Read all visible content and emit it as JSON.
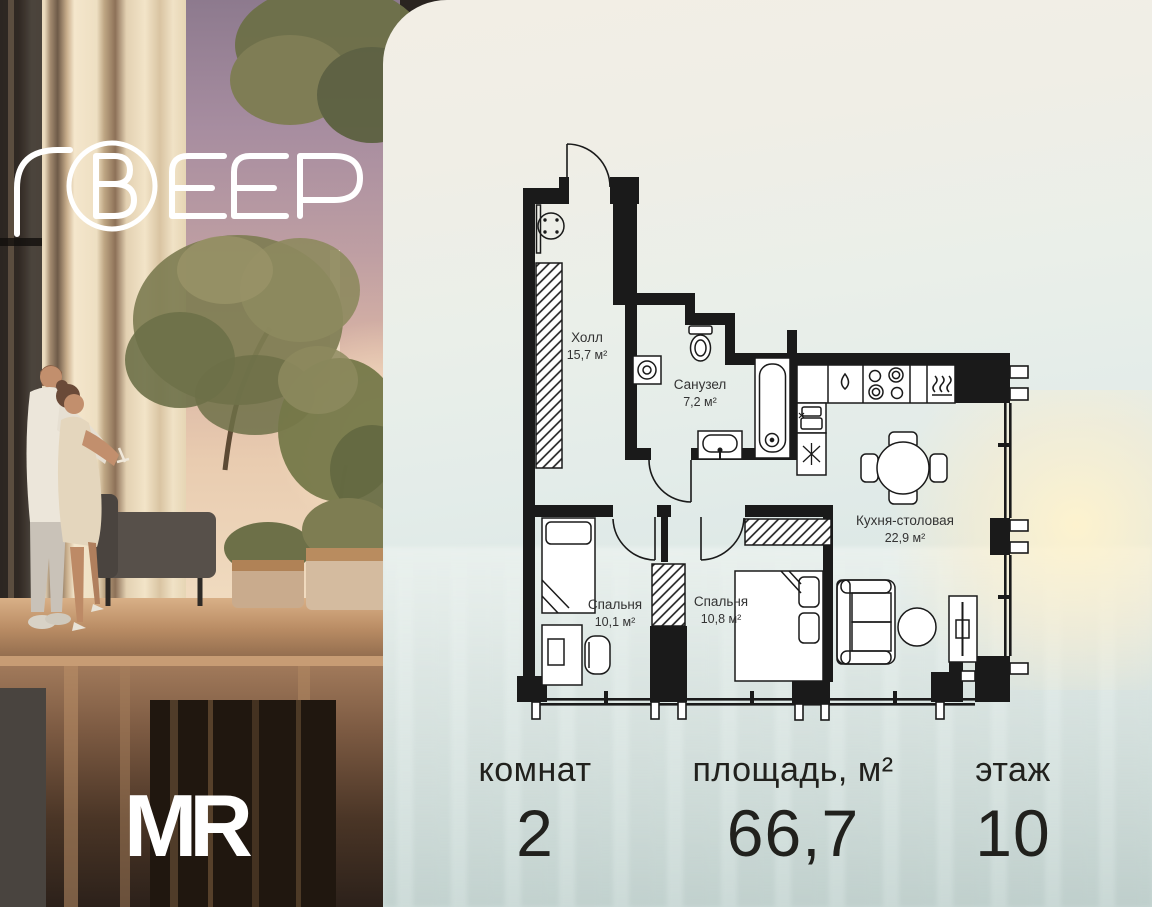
{
  "brand": {
    "project_logo": "ВЕЕР",
    "developer_logo": "MR"
  },
  "floor_plan": {
    "rooms": [
      {
        "name": "Холл",
        "area": "15,7 м²"
      },
      {
        "name": "Санузел",
        "area": "7,2 м²"
      },
      {
        "name": "Кухня-столовая",
        "area": "22,9 м²"
      },
      {
        "name": "Спальня",
        "area": "10,1 м²"
      },
      {
        "name": "Спальня",
        "area": "10,8 м²"
      }
    ]
  },
  "summary": {
    "rooms": {
      "label": "комнат",
      "value": "2"
    },
    "area": {
      "label": "площадь, м²",
      "value": "66,7"
    },
    "floor": {
      "label": "этаж",
      "value": "10"
    }
  },
  "colors": {
    "plan_line": "#1a1a1a",
    "panel_top": "#f2eee5",
    "panel_bottom": "#c9d8d6",
    "logo": "#ffffff",
    "sunset_sky": "#bf9fa3"
  }
}
